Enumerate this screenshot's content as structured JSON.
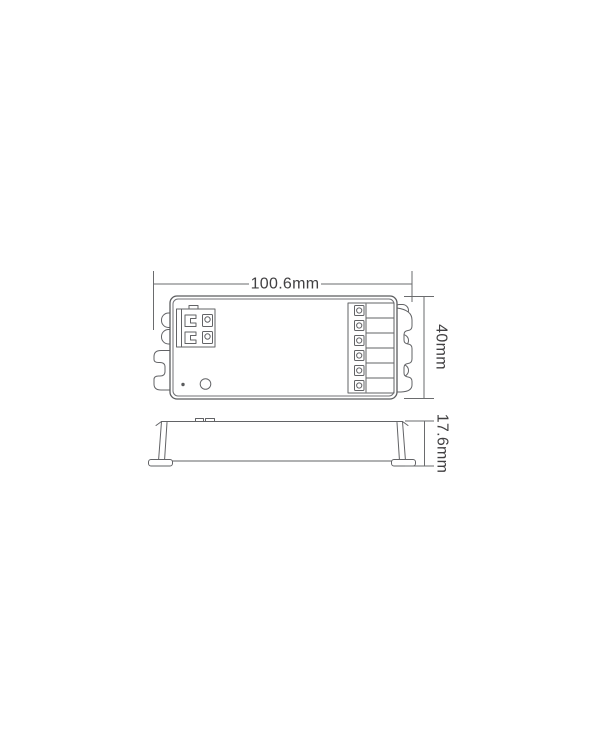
{
  "dimensions": {
    "width_label": "100.6mm",
    "height_label": "40mm",
    "depth_label": "17.6mm"
  },
  "device": {
    "left_terminal_count": 2,
    "right_terminal_count": 6
  },
  "colors": {
    "background": "#ffffff",
    "line": "#5b5c5e",
    "dimension_line": "#6a6b6d",
    "text": "#414042"
  }
}
